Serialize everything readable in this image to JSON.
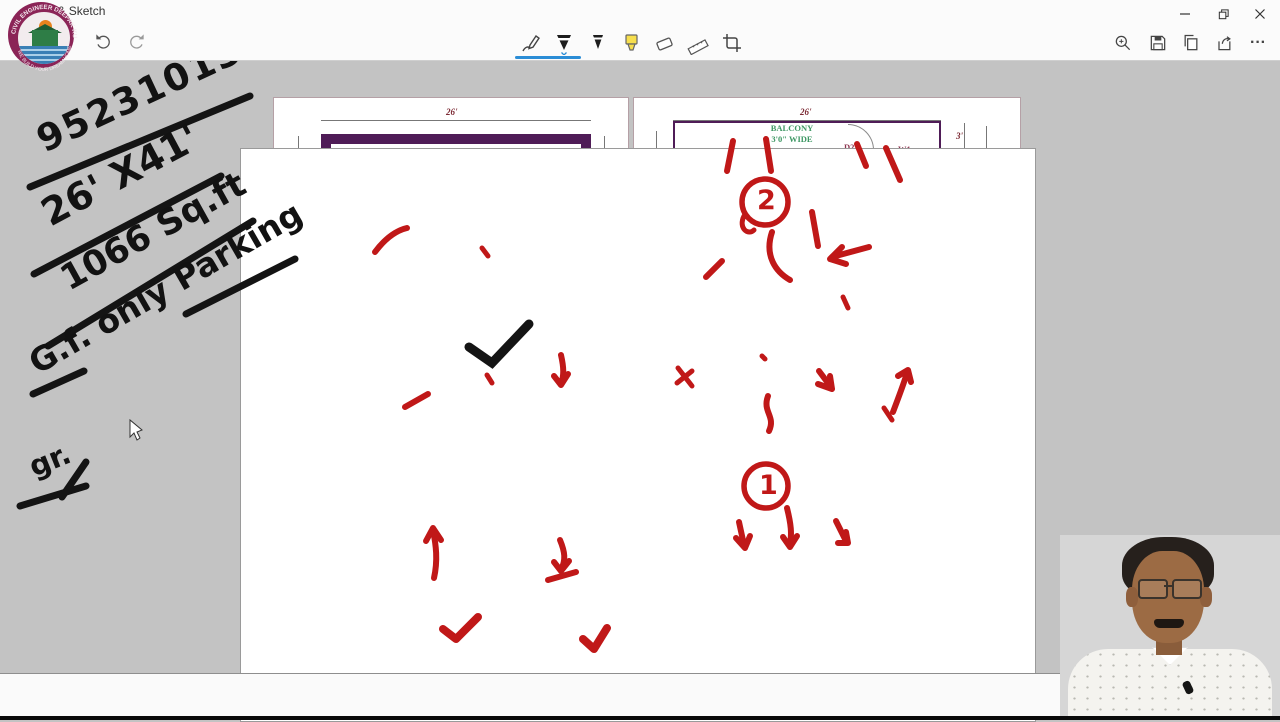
{
  "window": {
    "title": "Snip & Sketch",
    "controls": {
      "minimize": "–",
      "maximize": "restore",
      "close": "×"
    }
  },
  "toolbar": {
    "undo": "undo",
    "redo": "redo",
    "tools": [
      {
        "label": "Touch writing"
      },
      {
        "label": "Ballpoint pen",
        "selected": true
      },
      {
        "label": "Pencil"
      },
      {
        "label": "Highlighter"
      },
      {
        "label": "Eraser"
      },
      {
        "label": "Ruler"
      },
      {
        "label": "Crop"
      }
    ],
    "actions": [
      "Zoom",
      "Save",
      "Copy",
      "Share",
      "More"
    ],
    "more_label": "···"
  },
  "logo": {
    "top_text": "CIVIL ENGINEER DEEPAK KUMAR",
    "bottom_text": "WE BUILD YOUR DREAM HOME"
  },
  "handwriting": {
    "line1": "9523101369",
    "line2": "26' X41'",
    "line3": "1066 Sq.ft",
    "line4": "G.f. only Parking",
    "line5": "gr."
  },
  "annotations": {
    "circle_1": "1",
    "circle_2": "2"
  },
  "watermark": {
    "l1": "HOME PLAN & DESIGN",
    "l2": "Er.Dilip Prasad & Deepak Kumar",
    "l3": "M.NO : 9523101369"
  },
  "ground_floor": {
    "title": "GROUND FLOOR",
    "room": "PARKING",
    "main_gate": "MAIN GATE",
    "up": "UP",
    "w1": "W1",
    "file_path": "D:\\New Project (13).png",
    "dims": {
      "width_top": "26'",
      "height_left": "40'-9\"",
      "height_right": "40'-9\"",
      "gate": "12'",
      "width_bottom": "26'",
      "stair_h": "6'-9\"",
      "stair_w": "10'-3\"",
      "lobby_w": "7'-2\"",
      "lobby_h": "3'-6\""
    },
    "compass": {
      "e": "E",
      "n": "N",
      "s": "S",
      "w": "W",
      "road": "ROAD"
    }
  },
  "first_floor": {
    "title": "1ST FLOOR",
    "file_path": "D:\\New Project (13).png",
    "balcony_top": {
      "name": "BALCONY",
      "size": "3'0\" WIDE"
    },
    "balcony_bottom": {
      "name": "BALCONY",
      "size": "3'6\" WIDE"
    },
    "bed1": {
      "name": "BED ROOM",
      "size": "10'8\"X10'8\""
    },
    "puja": {
      "name": "PUJA RM",
      "size": "4'0\"X6'9\""
    },
    "kitchen": {
      "name": "KITCHEN",
      "size": "9'0\"X10'8\""
    },
    "bath": {
      "name": "BATH",
      "size": "7'7\"X4'6\""
    },
    "living": {
      "name": "LIVING/DINING",
      "size": "19'7\"X11'0\""
    },
    "bed2": {
      "name": "BED ROOM",
      "size": "12'0\"X12'3\""
    },
    "wc": {
      "name": "WC+BATH",
      "size": "8'6\"X4'6\""
    },
    "labels": {
      "d1": "D1",
      "d2": "D2",
      "w1": "W1",
      "wb": "W.B.",
      "up": "UP"
    },
    "dims": {
      "width_top": "26'",
      "balcony_top": "3'",
      "left": "42'-9\"",
      "right_outer": "42'-9\"",
      "right_inner": "37'-9\"",
      "bottom_right": "2'",
      "width_bottom": "26'",
      "stair_h": "6'-9\"",
      "stair_w": "10'-3\"",
      "lobby_w": "7'-2\"",
      "lobby_h": "3'-6\"",
      "lobby2": "3'-6\""
    },
    "compass": {
      "e": "E",
      "n": "N",
      "s": "S",
      "w": "W",
      "road": "ROAD"
    }
  }
}
